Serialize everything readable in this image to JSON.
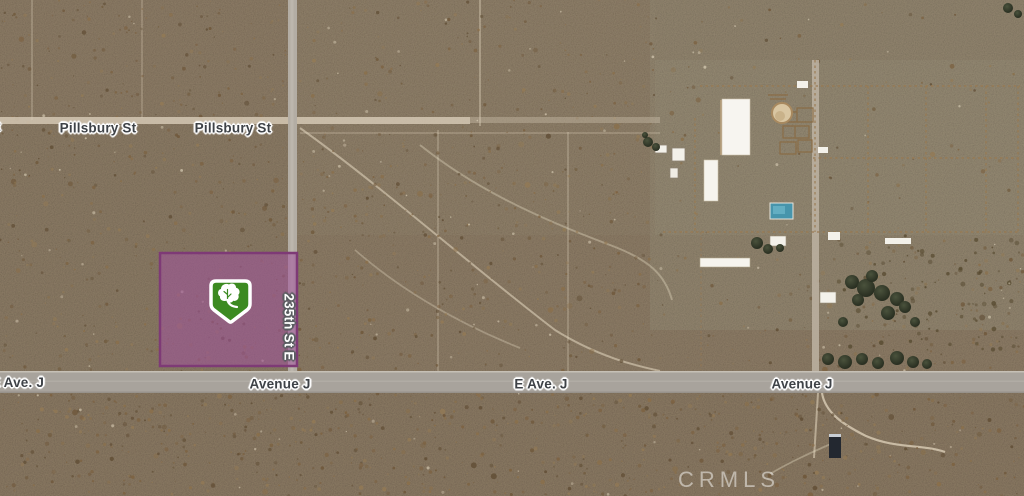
{
  "map": {
    "kind": "satellite-imagery",
    "labels": {
      "partial_street_left": "t",
      "pillsbury_1": "Pillsbury St",
      "pillsbury_2": "Pillsbury St",
      "street_235": "235th St E",
      "ave_j_left": "E Ave. J",
      "avenue_j_west": "Avenue J",
      "e_ave_j": "E Ave. J",
      "avenue_j_east": "Avenue J"
    },
    "watermark": "CRMLS",
    "parcel": {
      "fill": "#a0529c",
      "border": "#7e3a76",
      "fill_opacity": "0.55"
    },
    "marker": {
      "icon": "tree-shield-marker-icon",
      "green": "#3c8a21",
      "white": "#ffffff"
    },
    "colors": {
      "desert_base": "#d6bc9c",
      "road_primary": "#a8a39c",
      "road_secondary": "#b3ada4",
      "fence_brown": "#9a7a50"
    }
  }
}
